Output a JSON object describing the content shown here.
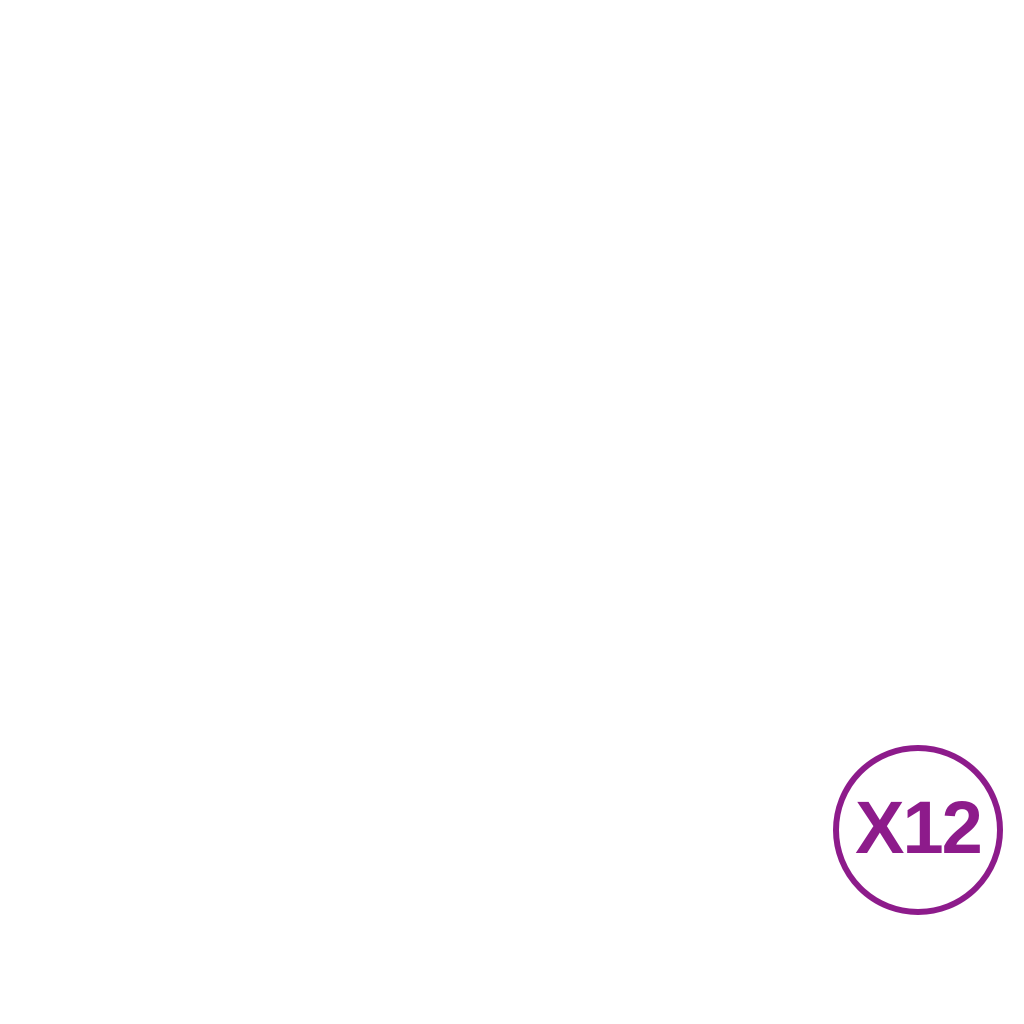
{
  "page": {
    "background": "#ffffff"
  },
  "panel": {
    "color_frame": "#343839",
    "color_bar": "#3e4244",
    "color_speckle_r": 0.52,
    "color_speckle_g": 0.55,
    "color_speckle_b": 0.57,
    "left_post": {
      "x": 28,
      "y": 112,
      "width": 13,
      "height": 799
    },
    "right_post": {
      "x": 800,
      "y": 112,
      "width": 13,
      "height": 799
    },
    "rails": [
      {
        "name": "top-rail",
        "x": 30,
        "y": 118,
        "width": 781,
        "height": 11
      },
      {
        "name": "middle-rail",
        "x": 36,
        "y": 502,
        "width": 769,
        "height": 11
      },
      {
        "name": "bottom-rail",
        "x": 30,
        "y": 893,
        "width": 781,
        "height": 12
      }
    ],
    "bars": {
      "count": 15,
      "first_center_x": 82,
      "spacing": 48.3,
      "width": 6.5,
      "upper": {
        "y1": 124,
        "y2": 507
      },
      "lower": {
        "y1": 507,
        "y2": 899,
        "x_offset": -2
      }
    },
    "tabs": {
      "centers_x": [
        226.9,
        420.1,
        613.3
      ],
      "width": 11,
      "height": 9,
      "top_y": 110,
      "bottom_y": 902
    },
    "holes": {
      "radius": 3.2,
      "color": "#ffffff",
      "left_x": 34.5,
      "right_x": 806.5,
      "ys": [
        157,
        401,
        646,
        863
      ]
    }
  },
  "badge": {
    "label": "X12",
    "color": "#8d1b8b",
    "center_x": 918,
    "center_y": 830,
    "radius": 85,
    "stroke_width": 6
  }
}
